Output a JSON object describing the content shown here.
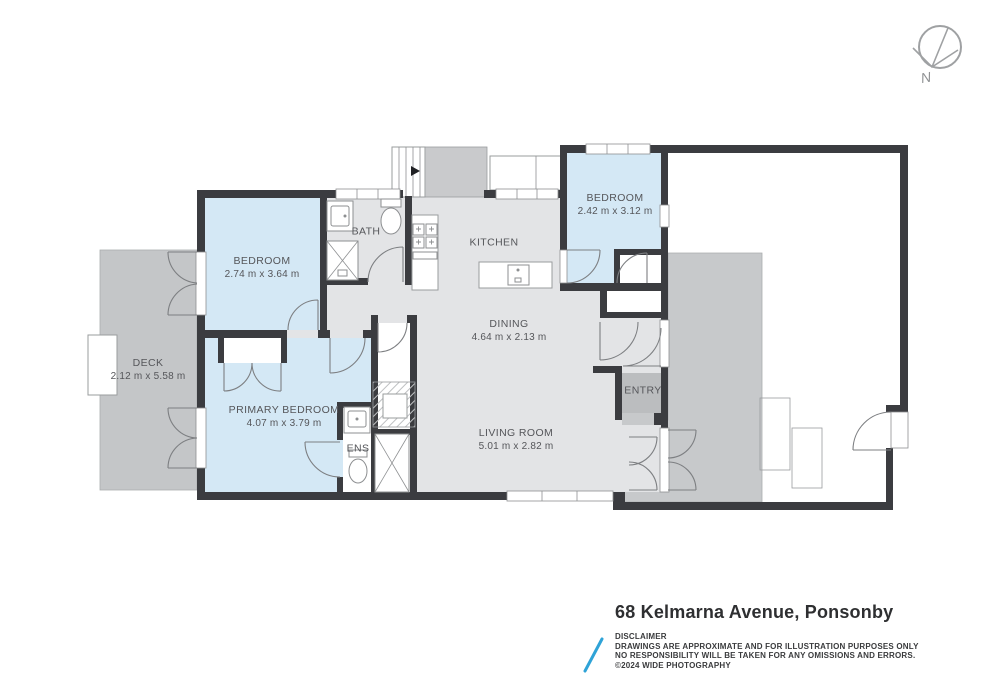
{
  "title_block": {
    "address_title": "68 Kelmarna Avenue, Ponsonby",
    "disclaimer_heading": "DISCLAIMER",
    "disclaimer_line1": "DRAWINGS ARE APPROXIMATE AND FOR ILLUSTRATION PURPOSES ONLY",
    "disclaimer_line2": "NO RESPONSIBILITY WILL BE TAKEN FOR ANY OMISSIONS AND ERRORS.",
    "disclaimer_line3": "©2024 WIDE PHOTOGRAPHY"
  },
  "compass": {
    "label": "N"
  },
  "rooms": [
    {
      "id": "bedroom-1",
      "label": "BEDROOM",
      "dims": "2.74 m x 3.64 m"
    },
    {
      "id": "bath",
      "label": "BATH",
      "dims": ""
    },
    {
      "id": "kitchen",
      "label": "KITCHEN",
      "dims": ""
    },
    {
      "id": "bedroom-2",
      "label": "BEDROOM",
      "dims": "2.42 m x 3.12 m"
    },
    {
      "id": "dining",
      "label": "DINING",
      "dims": "4.64 m x 2.13 m"
    },
    {
      "id": "deck",
      "label": "DECK",
      "dims": "2.12 m x 5.58 m"
    },
    {
      "id": "primary-bedroom",
      "label": "PRIMARY BEDROOM",
      "dims": "4.07 m x 3.79 m"
    },
    {
      "id": "ens",
      "label": "ENS",
      "dims": ""
    },
    {
      "id": "living-room",
      "label": "LIVING ROOM",
      "dims": "5.01 m x 2.82 m"
    },
    {
      "id": "entry",
      "label": "ENTRY",
      "dims": ""
    }
  ],
  "colors": {
    "wall": "#3b3c40",
    "room_blue": "#d4e8f5",
    "floor_gray": "#e3e4e6",
    "deck_gray": "#c4c6c8",
    "entry_gray": "#bbbdbf",
    "landing_gray": "#c9cacc",
    "logo_blue": "#2fa3d7",
    "label_text": "#55565a"
  }
}
